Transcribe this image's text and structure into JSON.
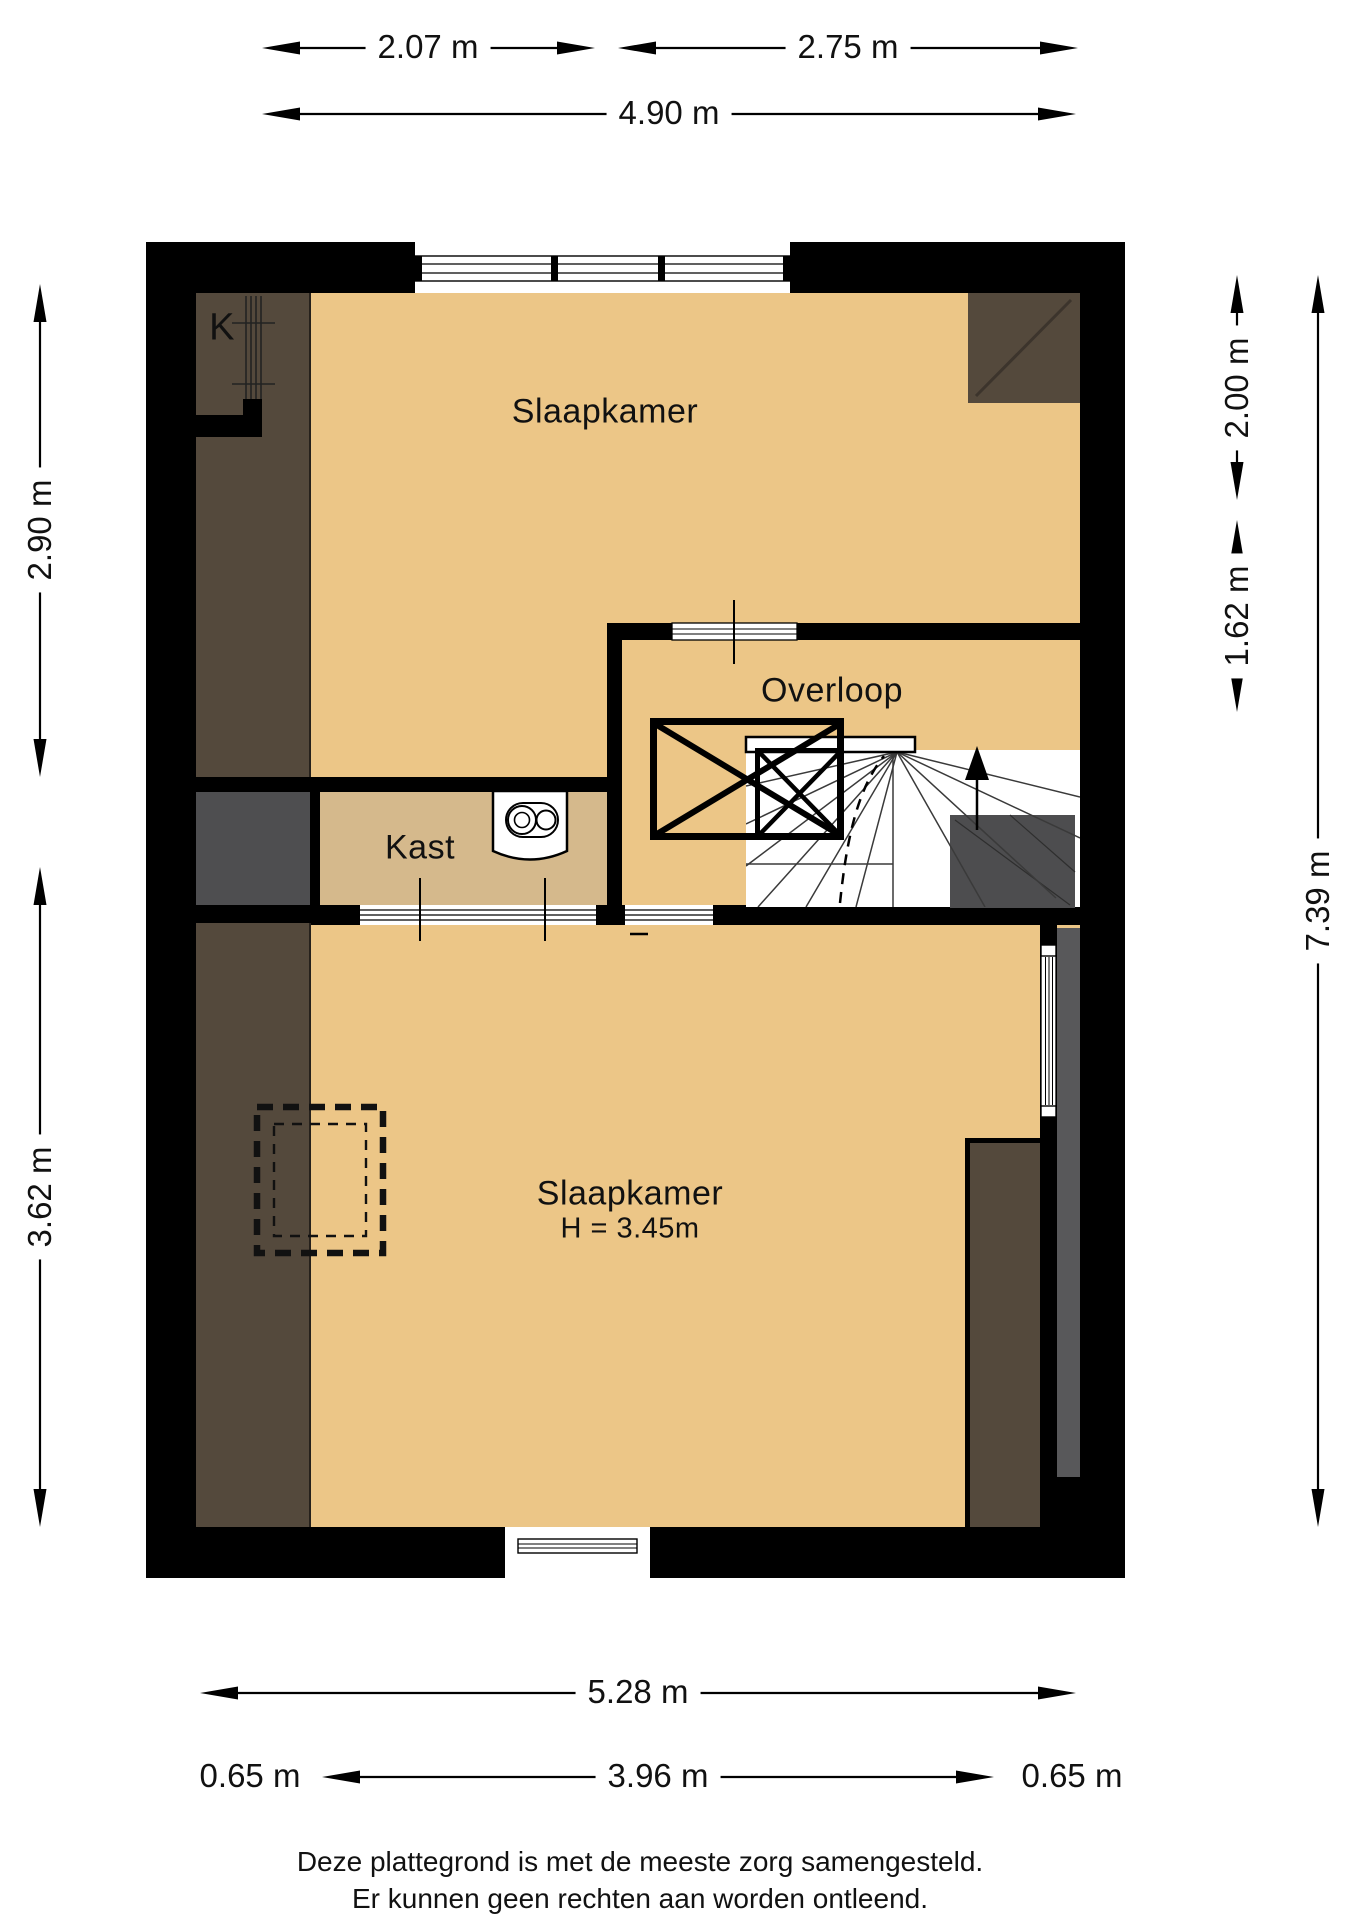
{
  "rooms": {
    "k_label": "K",
    "bedroom_top": {
      "name": "Slaapkamer"
    },
    "landing": {
      "name": "Overloop"
    },
    "closet": {
      "name": "Kast"
    },
    "bedroom_bottom": {
      "name": "Slaapkamer",
      "height": "H = 3.45m"
    }
  },
  "dimensions": {
    "top": {
      "d1": "2.07 m",
      "d2": "2.75 m",
      "total": "4.90 m"
    },
    "left": {
      "d1": "2.90 m",
      "d2": "3.62 m"
    },
    "right": {
      "d1": "2.00 m",
      "d2": "1.62 m",
      "total": "7.39 m"
    },
    "bottom": {
      "total": "5.28 m",
      "left": "0.65 m",
      "middle": "3.96 m",
      "right": "0.65 m"
    }
  },
  "footer": {
    "line1": "Deze plattegrond is met de meeste zorg samengesteld.",
    "line2": "Er kunnen geen rechten aan worden ontleend."
  },
  "colors": {
    "wall": "#000000",
    "floor": "#ecc687",
    "closet_floor": "#d5b98c",
    "sloped_ceiling": "#54493c",
    "dark_gray_area": "#4e4e50",
    "gray_strip": "#58585a",
    "stair_gray": "#4d4d4f"
  }
}
